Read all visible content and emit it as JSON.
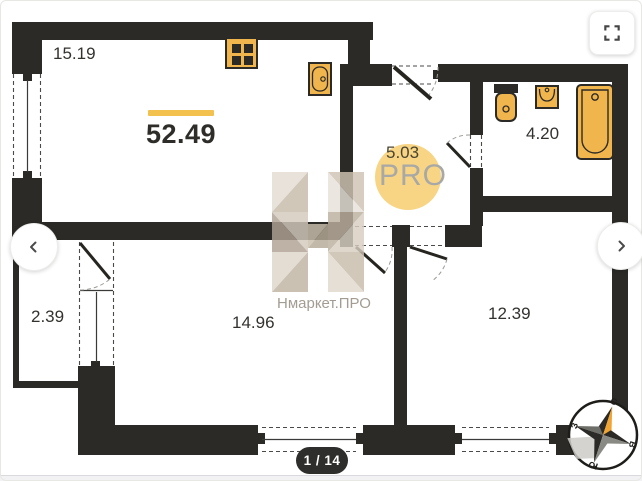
{
  "viewer": {
    "page_indicator": "1 / 14",
    "icons": {
      "fullscreen": "fullscreen-corners-icon",
      "prev": "chevron-left-icon",
      "next": "chevron-right-icon"
    }
  },
  "plan": {
    "total_area": "52.49",
    "areas": {
      "kitchen_living": "15.19",
      "hallway": "5.03",
      "bathroom": "4.20",
      "balcony": "2.39",
      "bedroom": "14.96",
      "living_room": "12.39"
    },
    "fixtures": [
      "stove",
      "kitchen-sink",
      "toilet",
      "washbasin",
      "bathtub"
    ],
    "compass": {
      "north": "С",
      "east": "В",
      "south": "Ю",
      "west": "З"
    }
  },
  "watermark": {
    "brand": "Нмаркет.ПРО",
    "badge": "PRO"
  },
  "colors": {
    "wall": "#2b2a27",
    "fixture_yellow": "#f0b54d",
    "highlight_yellow": "#f2c14e",
    "pro_circle": "#f7d584"
  }
}
